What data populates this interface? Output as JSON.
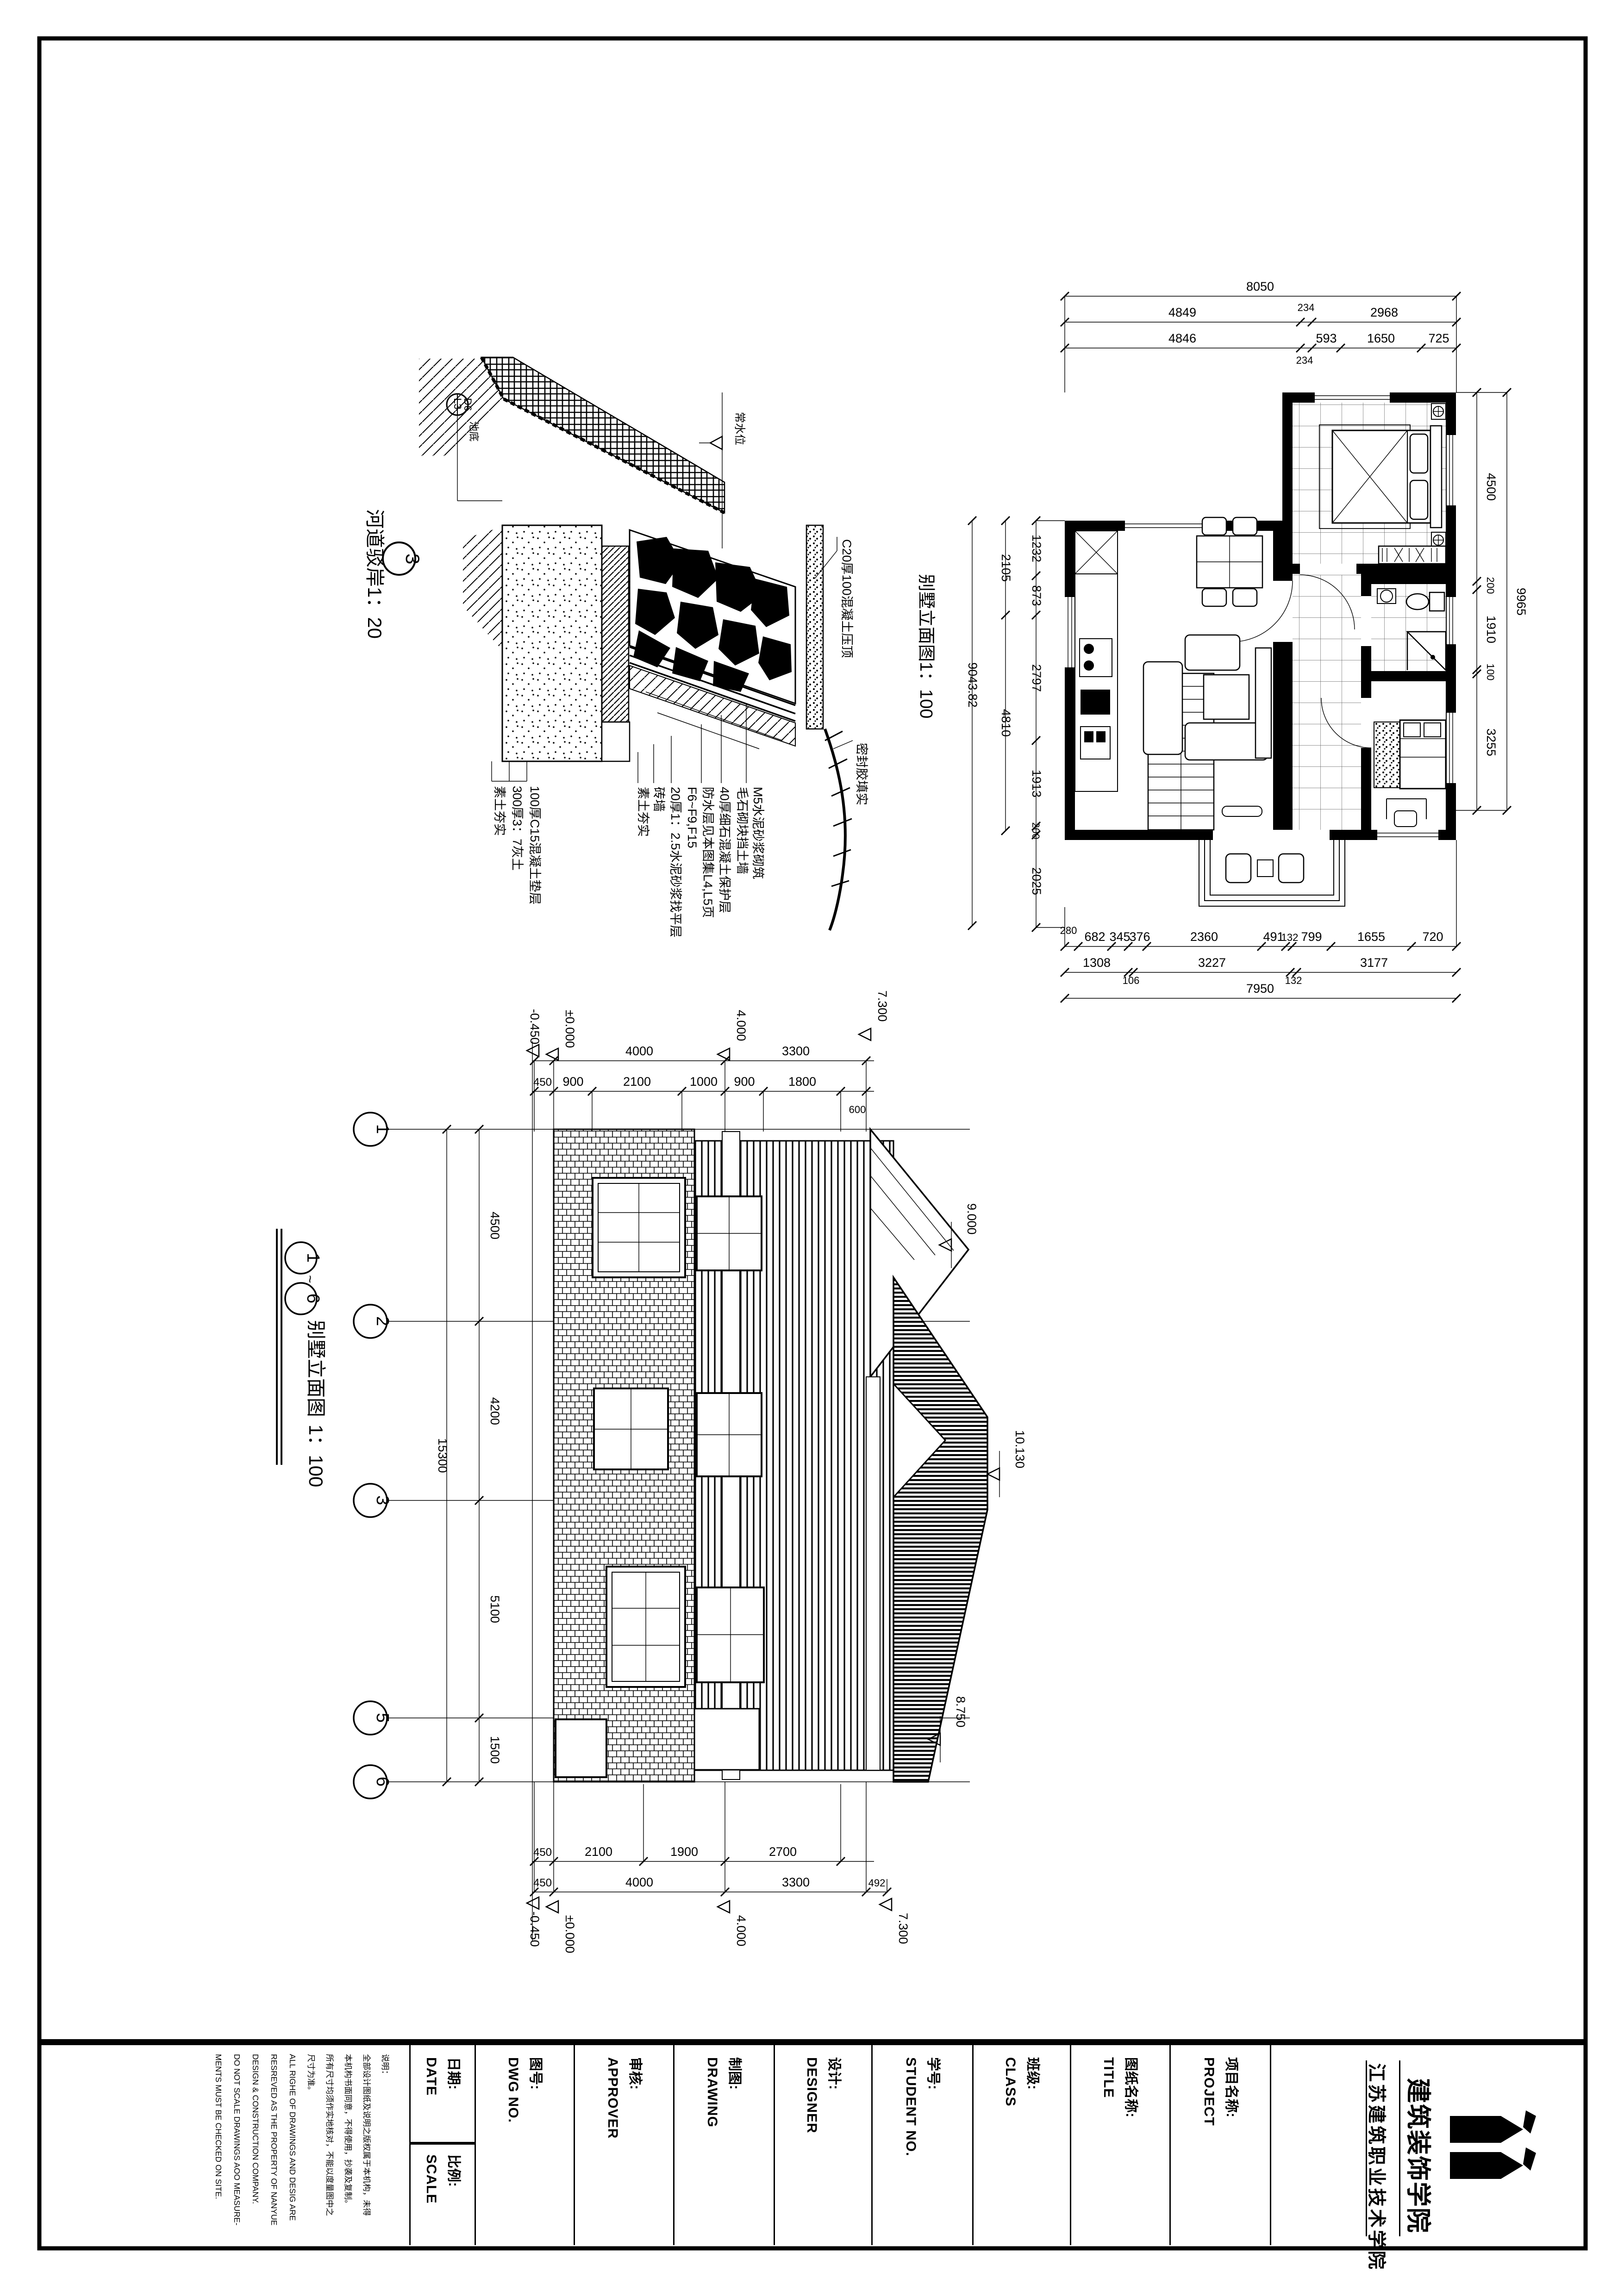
{
  "sheet": {
    "school_name": "江苏建筑职业技术学院",
    "college_logo_text": "建筑装饰学院"
  },
  "titleblock": {
    "notes_title": "说明：",
    "notes": [
      "全部设计图纸及说明之版权属于本机构，未得",
      "本机构书面同意，不得使用，抄袭及复制。",
      "所有尺寸均须作实地核对，不能以度量图中之",
      "尺寸为准。",
      "ALL RIGHE OF DRAWINGS AND DESIG ARE",
      "RESREVED AS THE PROPERTY OF NANYUE",
      "DESIGN & CONSTRUCTION COMPANY.",
      "DO NOT SCALE DRAWINGS AOO MEASURE-",
      "MENTS MUST BE CHECKED ON SITE."
    ],
    "date_cn": "日期:",
    "date_en": "DATE",
    "scale_cn": "比例:",
    "scale_en": "SCALE",
    "dwg_cn": "图号:",
    "dwg_en": "DWG NO.",
    "approver_cn": "审核:",
    "approver_en": "APPROVER",
    "drawing_cn": "制图:",
    "drawing_en": "DRAWING",
    "designer_cn": "设计:",
    "designer_en": "DESIGNER",
    "student_cn": "学号:",
    "student_en": "STUDENT NO.",
    "class_cn": "班级:",
    "class_en": "CLASS",
    "title_cn": "图纸名称:",
    "title_en": "TITLE",
    "project_cn": "项目名称:",
    "project_en": "PROJECT"
  },
  "detail": {
    "title": "河道驳岸1：20",
    "number": "3",
    "callout_top": "D6",
    "callout_bottom": "L3",
    "pool_label": "池底",
    "water_label": "常水位",
    "left_labels": [
      "100厚C15混凝土垫层",
      "300厚3：7灰土",
      "素土夯实"
    ],
    "right_labels": [
      "M5水泥砂浆砌筑",
      "毛石砌块挡土墙",
      "40厚细石混凝土保护层",
      "防水层见本图集L4,L5页",
      "F6~F9,F15",
      "20厚1：2.5水泥砂浆找平层",
      "砖墙",
      "素土夯实"
    ],
    "coping_label": "C20厚100混凝土压顶",
    "seal_label": "密封胶填实"
  },
  "plan": {
    "side_label": "别墅立面图1：100",
    "dims_top1": "8050",
    "dims_top2": [
      "4849",
      "234",
      "2968"
    ],
    "dims_top3": [
      "4846",
      "234",
      "593",
      "1650",
      "725"
    ],
    "dims_bottom1": [
      "280",
      "682",
      "345",
      "376",
      "2360",
      "491",
      "132",
      "799",
      "1655",
      "720"
    ],
    "dims_bottom2": [
      "1308",
      "106",
      "3227",
      "132",
      "3177"
    ],
    "dims_bottom3": "7950",
    "dims_left_outer": "9043.82",
    "dims_left_mid": [
      "2105",
      "4810"
    ],
    "dims_left_inner": [
      "1232",
      "873",
      "2797",
      "1913",
      "200",
      "2025"
    ],
    "dims_right_inner": [
      "4500",
      "200",
      "1910",
      "100",
      "3255"
    ],
    "dims_right_outer": "9965"
  },
  "elevation": {
    "axis_start": "1",
    "tilde": "~",
    "axis_end": "6",
    "title": "别墅立面图",
    "scale": "1：100",
    "bubbles": [
      "1",
      "2",
      "3",
      "5",
      "6"
    ],
    "axis_dims": [
      "4500",
      "4200",
      "5100",
      "1500"
    ],
    "axis_total": "15300",
    "top_levels": [
      "-0.450",
      "±0.000",
      "4.000",
      "7.300"
    ],
    "top_dims1": [
      "4000",
      "3300"
    ],
    "top_dims2": [
      "450",
      "900",
      "2100",
      "1000",
      "900",
      "1800"
    ],
    "top_dim_600": "600",
    "right_levels": [
      "9.000",
      "10.130",
      "8.750"
    ],
    "bottom_dims1": [
      "450",
      "2100",
      "1900",
      "2700"
    ],
    "bottom_dims2": [
      "450",
      "4000",
      "3300",
      "492"
    ],
    "bottom_levels": [
      "-0.450",
      "±0.000",
      "4.000",
      "7.300"
    ]
  }
}
